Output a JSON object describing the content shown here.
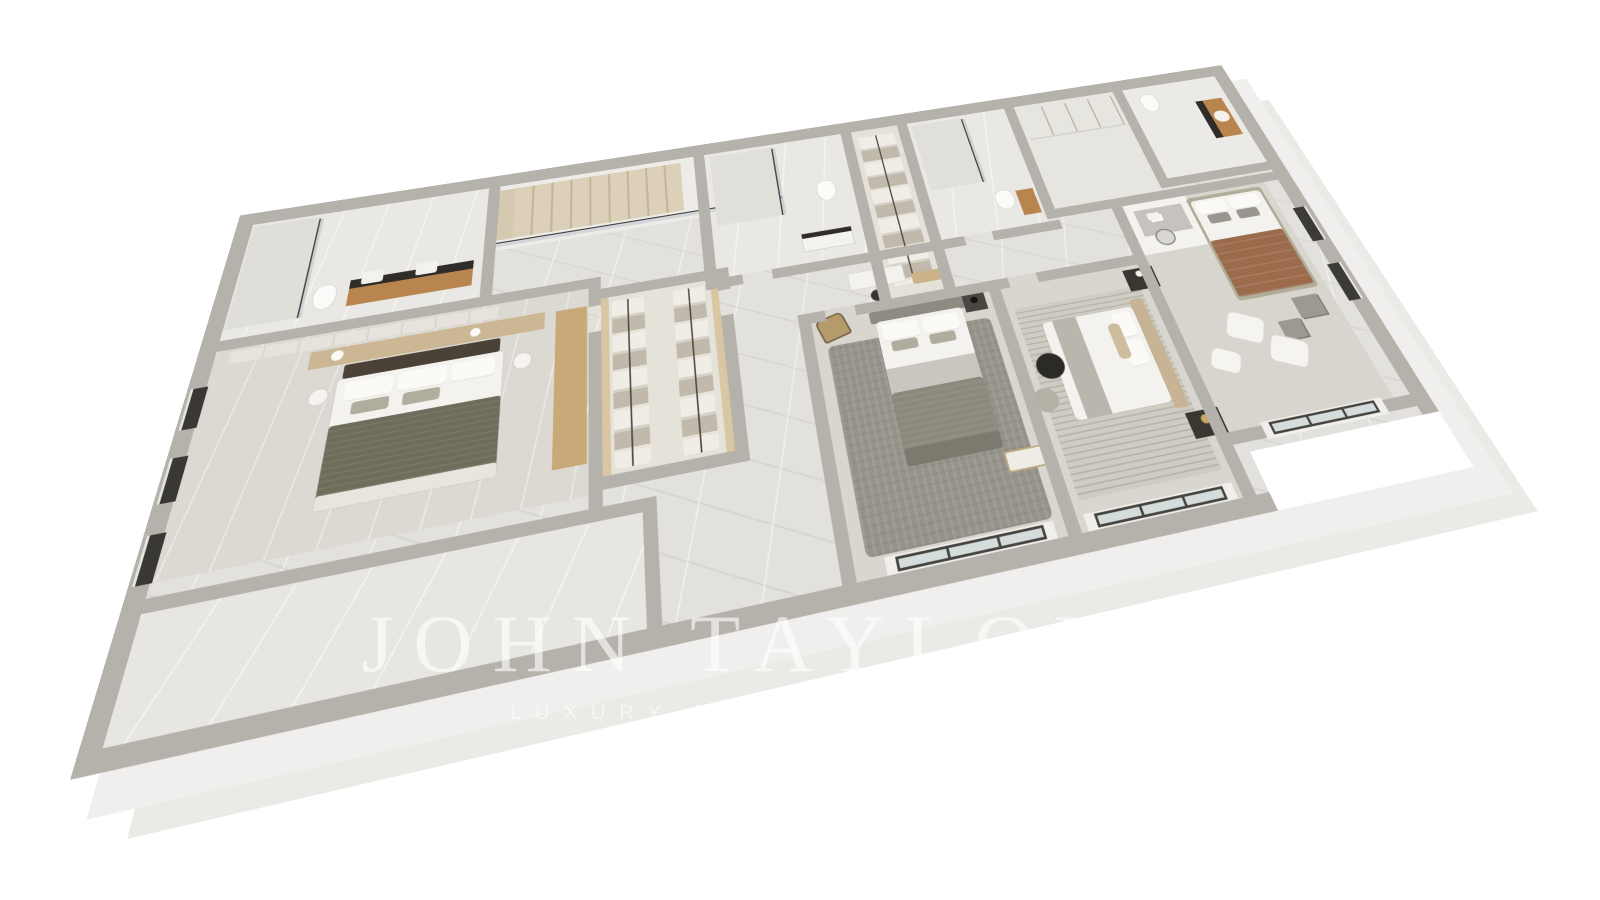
{
  "watermark": {
    "title": "JOHN TAYLOR",
    "subtitle": "LUXURY REAL ESTATE",
    "color": "#ffffff"
  },
  "palette": {
    "background": "#ffffff",
    "outer_wall_top": "#b5b1ab",
    "outer_wall_face": "#f1efed",
    "inner_wall": "#b5b1ab",
    "floor_base": "#e3e1dd",
    "floor_bedroom": "#dbd8d2",
    "floor_bath_marble": "#eae8e4",
    "wood_vanity": "#b9854f",
    "wood_wardrobe": "#d9c6a3",
    "stairs": "#dcd1b8",
    "glass_frame": "#45443f",
    "glass_tint": "#aFc0c6",
    "rug_shag": "#96948a",
    "rug_striped": "#c9c6be",
    "bed_linen": "#f4f2ee",
    "throw_olive": "#6e6d5b",
    "blanket_brown": "#9b6b4b",
    "headboard_dark": "#4a4137",
    "nightstand_dark": "#3a3631"
  },
  "scene": {
    "type": "isometric-3d-floor-plan-render",
    "rooms": [
      "bathroom-1",
      "staircase",
      "walk-in-closet",
      "bathroom-2",
      "linen-closet",
      "bathroom-3",
      "wardrobe-room",
      "bathroom-4",
      "desk-nook",
      "bedroom-1",
      "bedroom-2",
      "bedroom-3",
      "bedroom-4",
      "hallway",
      "empty-room"
    ]
  }
}
